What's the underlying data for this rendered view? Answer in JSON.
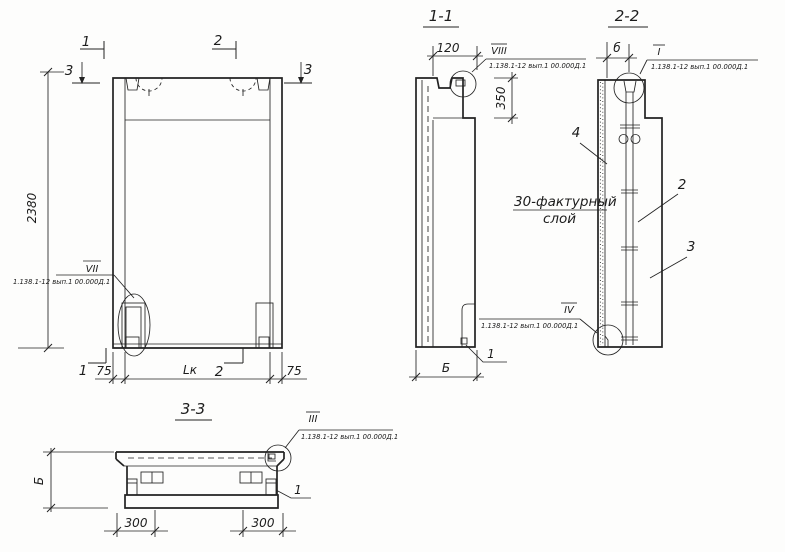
{
  "callout_ref": "1.138.1-12 вып.1 00.000Д.1",
  "front_view": {
    "mark_1_top": "1",
    "mark_2_top": "2",
    "mark_3_left": "3",
    "mark_3_right": "3",
    "mark_1_bottom": "1",
    "mark_2_bottom": "2",
    "detail_vii": "VII",
    "dim_height": "2380",
    "dim_edge_left": "75",
    "dim_length": "Lк",
    "dim_edge_right": "75"
  },
  "section_1_1": {
    "title": "1-1",
    "detail_viii": "VIII",
    "dim_recess": "120",
    "dim_flange": "350",
    "dim_width": "Б",
    "item_1": "1"
  },
  "section_2_2": {
    "title": "2-2",
    "detail_i": "I",
    "detail_iv": "IV",
    "dim_rib": "б",
    "item_2": "2",
    "item_3": "3",
    "item_4": "4",
    "note_line1": "30-фактурный",
    "note_line2": "слой"
  },
  "section_3_3": {
    "title": "3-3",
    "detail_iii": "III",
    "dim_width": "Б",
    "dim_offset_left": "300",
    "dim_offset_right": "300",
    "item_1": "1"
  }
}
